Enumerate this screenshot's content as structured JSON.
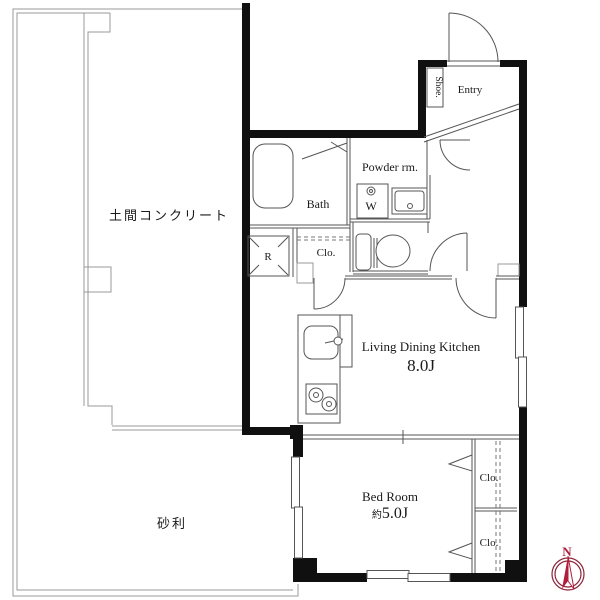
{
  "floorplan": {
    "rooms": {
      "doma": "土間コンクリート",
      "gravel": "砂利",
      "entry": "Entry",
      "shoe": "Shoe.",
      "bath": "Bath",
      "powder_room": "Powder rm.",
      "washer": "W",
      "refrigerator": "R",
      "hall_closet": "Clo.",
      "ldk_name": "Living Dining Kitchen",
      "ldk_size": "8.0J",
      "bedroom_name": "Bed Room",
      "bedroom_size_prefix": "約",
      "bedroom_size": "5.0J",
      "closet_upper": "Clo.",
      "closet_lower": "Clo."
    },
    "compass": {
      "north": "N"
    },
    "colors": {
      "wall": "#101010",
      "interior_line": "#555555",
      "site_boundary": "#999999",
      "text": "#1a1a1a",
      "compass_red": "#b01e3c",
      "background": "#ffffff"
    }
  }
}
